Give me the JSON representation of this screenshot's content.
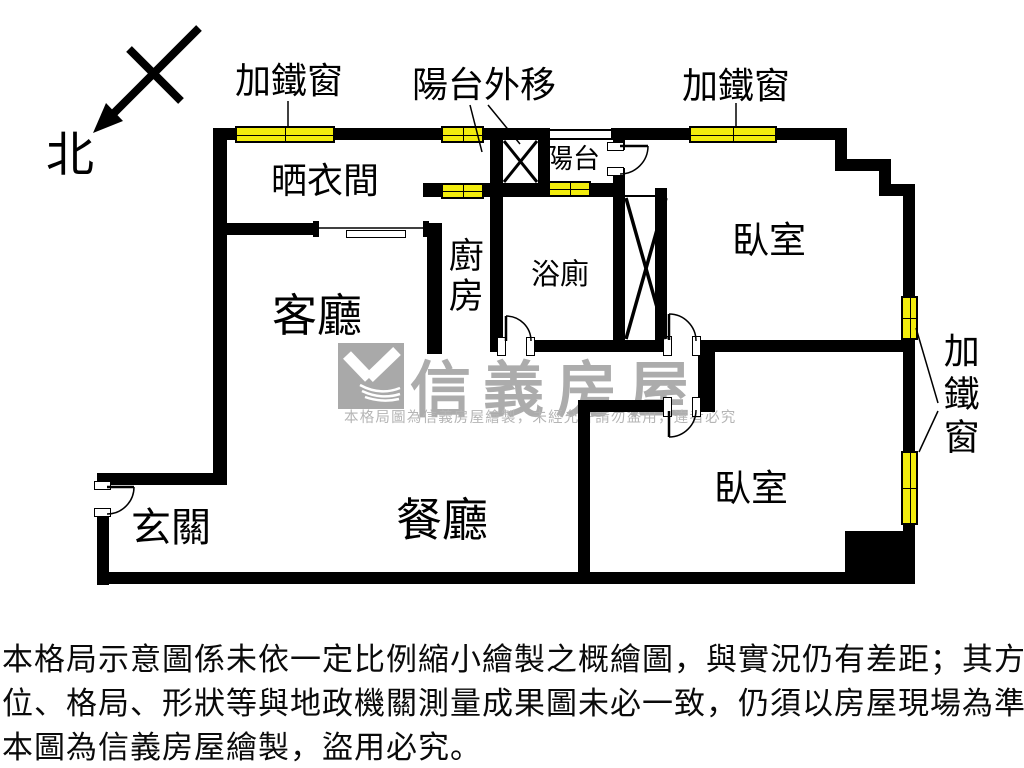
{
  "compass": {
    "north_label": "北"
  },
  "labels": {
    "iron_window_top_left": "加鐵窗",
    "balcony_moved_out": "陽台外移",
    "iron_window_top_right": "加鐵窗",
    "iron_window_right_side": "加鐵窗"
  },
  "rooms": {
    "drying_room": "晒衣間",
    "living_room": "客廳",
    "kitchen": "廚房",
    "balcony": "陽台",
    "bathroom": "浴廁",
    "bedroom_top": "臥室",
    "bedroom_bottom": "臥室",
    "dining_room": "餐廳",
    "entryway": "玄關"
  },
  "watermark": {
    "brand": "信義房屋",
    "notice": "本格局圖為信義房屋繪製，未經允許請勿盜用，違者必究"
  },
  "disclaimer": {
    "line1": "本格局示意圖係未依一定比例縮小繪製之概繪圖，與實況仍有差距；其方",
    "line2": "位、格局、形狀等與地政機關測量成果圖未必一致，仍須以房屋現場為準。",
    "line3": "本圖為信義房屋繪製，盜用必究。"
  },
  "colors": {
    "wall": "#000000",
    "window_fill": "#f2ec0d",
    "watermark_gray": "#ababab"
  }
}
